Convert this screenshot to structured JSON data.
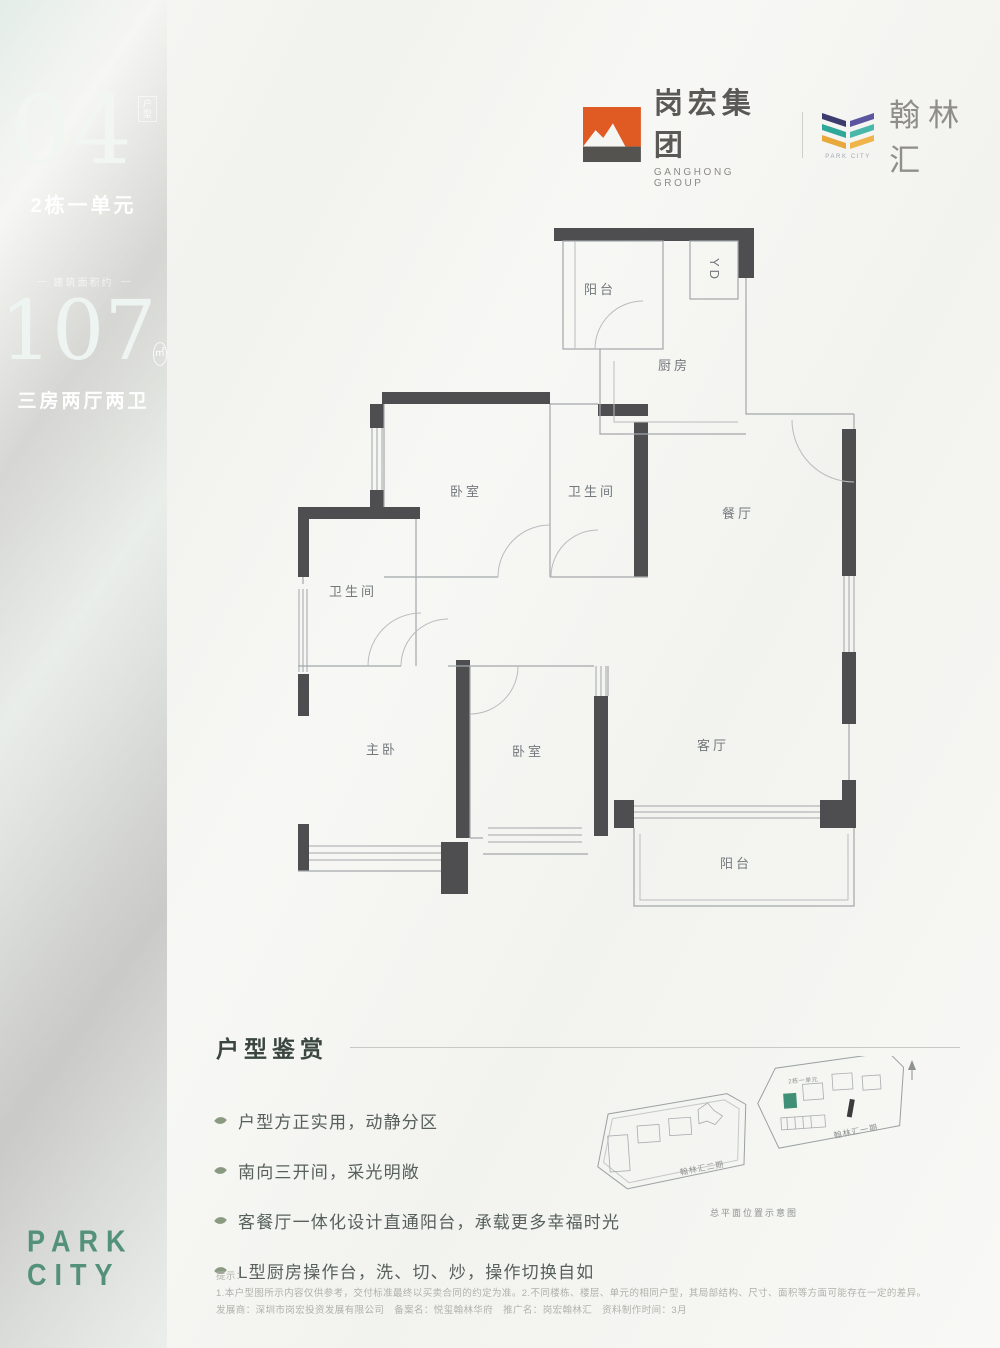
{
  "sidebar": {
    "unit_number": "04",
    "unit_number_tag": "户型",
    "unit_building": "2栋一单元",
    "area_caption": "建筑面积约",
    "area_value": "107",
    "area_unit": "㎡",
    "layout_text": "三房两厅两卫",
    "brand_line1": "PARK",
    "brand_line2": "CITY"
  },
  "header": {
    "ganghong_name": "岗宏集团",
    "ganghong_en": "GANGHONG GROUP",
    "hanlin_name": "翰林汇",
    "hanlin_en": "PARK CITY"
  },
  "plan": {
    "rooms": [
      {
        "label": "阳台"
      },
      {
        "label": "YD"
      },
      {
        "label": "厨房"
      },
      {
        "label": "餐厅"
      },
      {
        "label": "卧室"
      },
      {
        "label": "卫生间"
      },
      {
        "label": "卫生间"
      },
      {
        "label": "主卧"
      },
      {
        "label": "卧室"
      },
      {
        "label": "客厅"
      },
      {
        "label": "阳台"
      }
    ]
  },
  "features": {
    "title": "户型鉴赏",
    "items": [
      "户型方正实用，动静分区",
      "南向三开间，采光明敞",
      "客餐厅一体化设计直通阳台，承载更多幸福时光",
      "L型厨房操作台，洗、切、炒，操作切换自如"
    ]
  },
  "siteplan": {
    "phase1_label": "翰林汇一期",
    "phase2_label": "翰林汇二期",
    "highlight_label": "2栋一单元",
    "caption": "总平面位置示意图"
  },
  "disclaimer": {
    "title": "提示：",
    "line1": "1.本户型图所示内容仅供参考，交付标准最终以买卖合同的约定为准。2.不同楼栋、楼层、单元的相同户型，其局部结构、尺寸、面积等方面可能存在一定的差异。",
    "line2": "发展商：深圳市岗宏投资发展有限公司　备案名：悦玺翰林华府　推广名：岗宏翰林汇　资料制作时间：3月"
  },
  "colors": {
    "sidebar_green": "#0e4032",
    "brand_green": "#549179",
    "logo_orange": "#e05a23",
    "logo_dark": "#55534f",
    "logo_purple": "#41418a",
    "logo_teal": "#2aa89a",
    "logo_yellow": "#e9a83d",
    "wall_dark": "#4e4e50",
    "highlight_building": "#3f9077"
  }
}
